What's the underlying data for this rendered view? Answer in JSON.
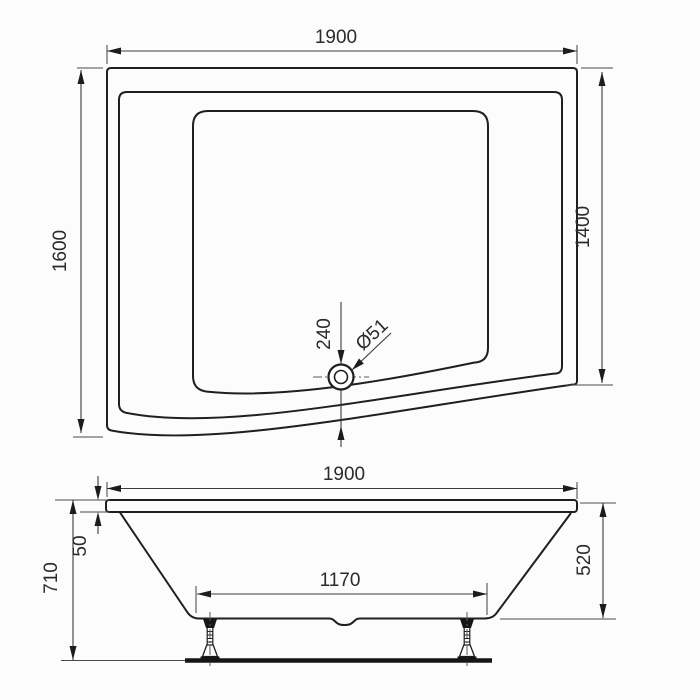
{
  "drawing": {
    "type": "bathtub-technical-drawing",
    "top_view": {
      "dims": {
        "width": "1900",
        "left_side": "1600",
        "right_side": "1400",
        "drain_offset": "240",
        "drain_diameter": "Ø51"
      }
    },
    "side_view": {
      "dims": {
        "width": "1900",
        "overall_height": "710",
        "rim_thickness": "50",
        "skirt_height": "520",
        "bottom_length": "1170"
      }
    }
  }
}
